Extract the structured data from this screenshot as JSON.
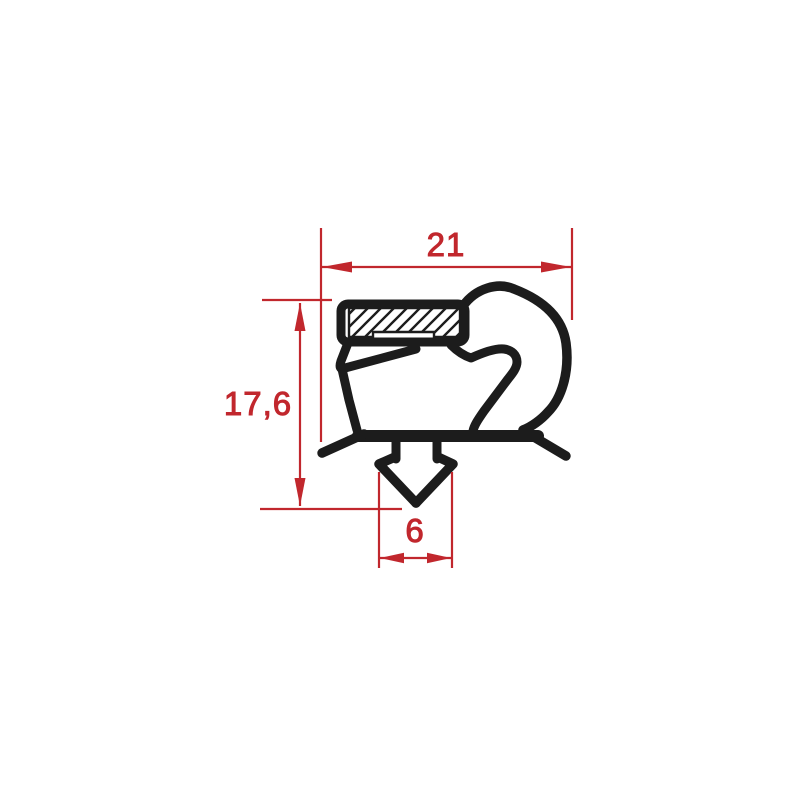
{
  "diagram": {
    "type": "technical-drawing",
    "subject": "door gasket profile cross-section with magnet pocket, balloon lobe and barbed anchor dart",
    "background": "#ffffff",
    "colors": {
      "profile": "#1c1c1c",
      "dimension": "#c1272d"
    },
    "dims": {
      "overall_width": {
        "label": "21",
        "value": 21,
        "orientation": "horizontal",
        "measures": "overall profile width"
      },
      "overall_height": {
        "label": "17,6",
        "value": 17.6,
        "orientation": "vertical",
        "measures": "overall profile height"
      },
      "dart_width": {
        "label": "6",
        "value": 6,
        "orientation": "horizontal",
        "measures": "anchor dart width"
      }
    }
  }
}
